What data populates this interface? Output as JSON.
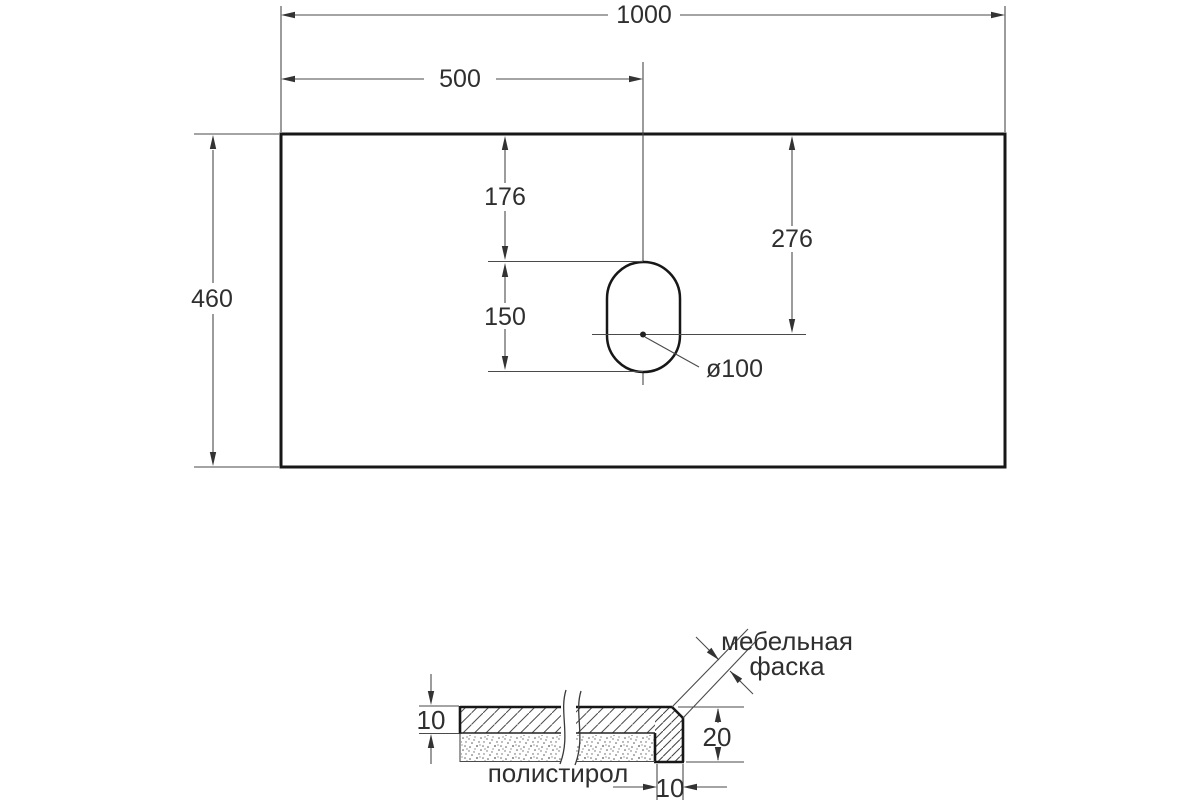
{
  "drawing": {
    "type": "countertop technical drawing, top view and edge cross-section",
    "top_view": {
      "plate_width_label": "1000",
      "hole_center_x_label": "500",
      "plate_depth_label": "460",
      "hole_top_offset_label": "176",
      "hole_length_label": "150",
      "hole_center_offset_label": "276",
      "hole_diameter_label": "ø100"
    },
    "section_view": {
      "top_thickness_label": "10",
      "edge_height_label": "20",
      "edge_width_label": "10",
      "chamfer_label_line1": "мебельная",
      "chamfer_label_line2": "фаска",
      "filler_label": "полистирол"
    },
    "colors": {
      "background": "#ffffff",
      "outline": "#171717",
      "dimension_line": "#4a4a4a",
      "text": "#2f2f2f"
    }
  }
}
